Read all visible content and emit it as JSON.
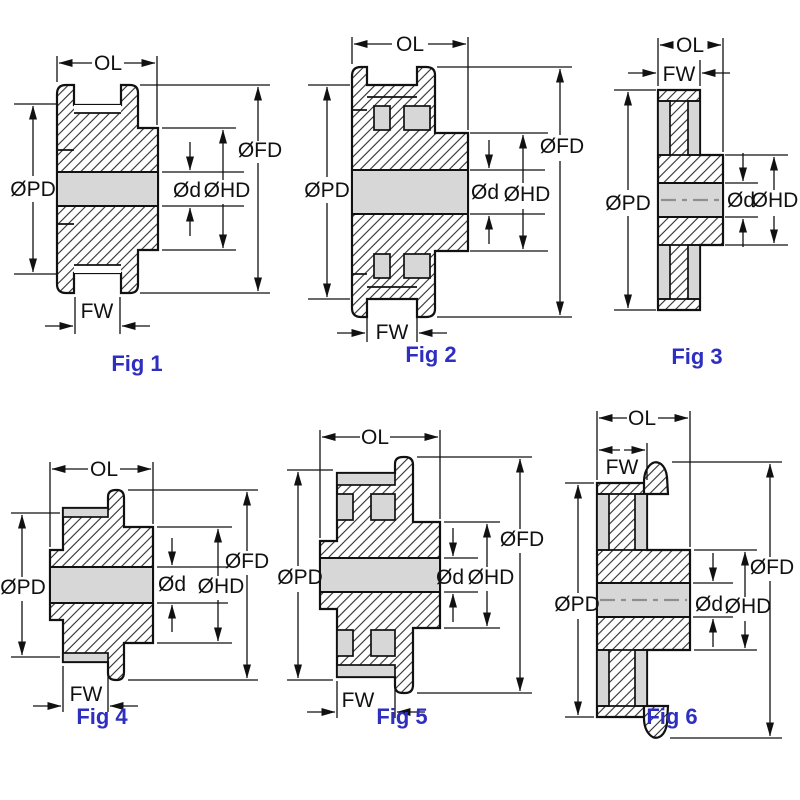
{
  "drawing": {
    "background": "#ffffff",
    "colors": {
      "line": "#111111",
      "fill_gray": "#d7d7d7",
      "caption_blue": "#2e2ec0"
    },
    "figures": [
      {
        "caption": "Fig 1",
        "labels": {
          "ol": "OL",
          "fw": "FW",
          "pd": "ØPD",
          "fd": "ØFD",
          "hd": "ØHD",
          "d": "Ød"
        }
      },
      {
        "caption": "Fig 2",
        "labels": {
          "ol": "OL",
          "fw": "FW",
          "pd": "ØPD",
          "fd": "ØFD",
          "hd": "ØHD",
          "d": "Ød"
        }
      },
      {
        "caption": "Fig 3",
        "labels": {
          "ol": "OL",
          "fw": "FW",
          "pd": "ØPD",
          "hd": "ØHD",
          "d": "Ød"
        }
      },
      {
        "caption": "Fig 4",
        "labels": {
          "ol": "OL",
          "fw": "FW",
          "pd": "ØPD",
          "fd": "ØFD",
          "hd": "ØHD",
          "d": "Ød"
        }
      },
      {
        "caption": "Fig 5",
        "labels": {
          "ol": "OL",
          "fw": "FW",
          "pd": "ØPD",
          "fd": "ØFD",
          "hd": "ØHD",
          "d": "Ød"
        }
      },
      {
        "caption": "Fig 6",
        "labels": {
          "ol": "OL",
          "fw": "FW",
          "pd": "ØPD",
          "fd": "ØFD",
          "hd": "ØHD",
          "d": "Ød"
        }
      }
    ]
  }
}
